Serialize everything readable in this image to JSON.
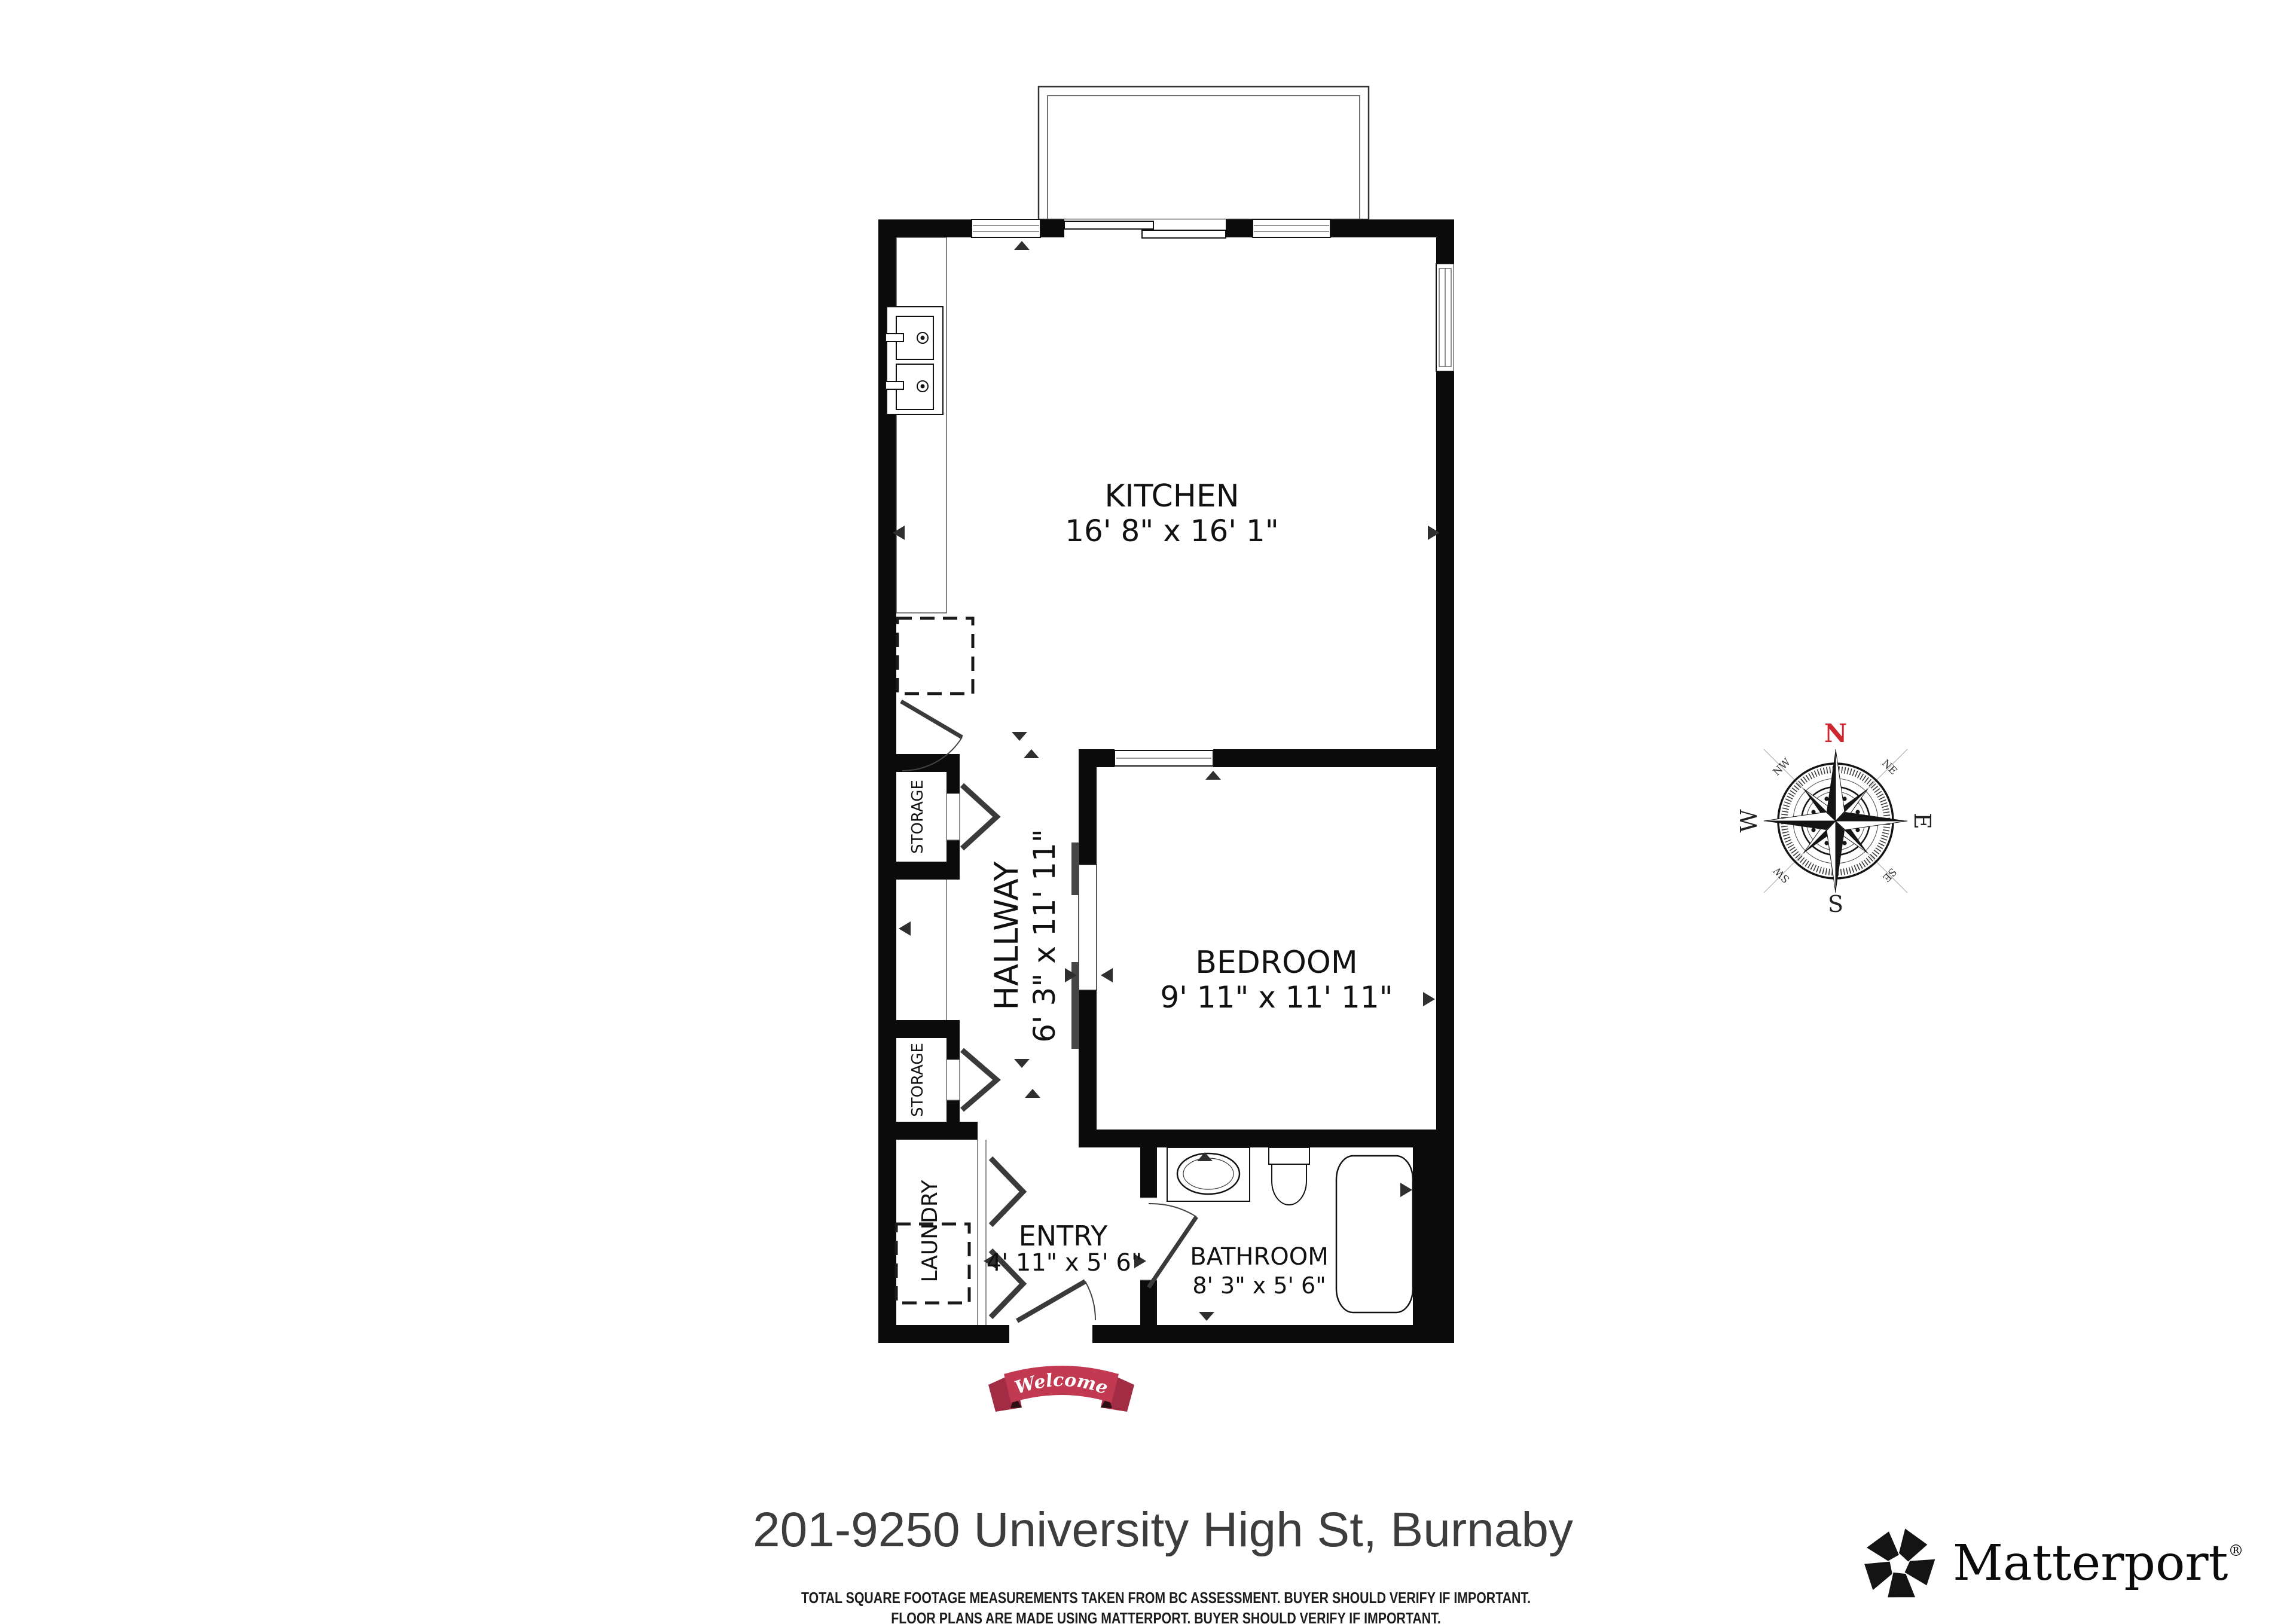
{
  "address": "201-9250 University High St, Burnaby",
  "disclaimer": {
    "line1": "TOTAL SQUARE FOOTAGE MEASUREMENTS TAKEN FROM BC ASSESSMENT. BUYER SHOULD VERIFY IF IMPORTANT.",
    "line2": "FLOOR PLANS ARE MADE USING MATTERPORT. BUYER SHOULD VERIFY IF IMPORTANT."
  },
  "branding": {
    "name": "Matterport",
    "registered": "®"
  },
  "banner": {
    "text": "Welcome",
    "ribbon_color": "#c23a52",
    "tail_color": "#a12c44"
  },
  "compass": {
    "north": "N",
    "east": "E",
    "south": "S",
    "west": "W",
    "northeast": "NE",
    "northwest": "NW",
    "southeast": "SE",
    "southwest": "SW",
    "north_color": "#cf2730"
  },
  "rooms": {
    "kitchen": {
      "name": "KITCHEN",
      "dims": "16' 8\" x 16' 1\""
    },
    "bedroom": {
      "name": "BEDROOM",
      "dims": "9' 11\" x 11' 11\""
    },
    "hallway": {
      "name": "HALLWAY",
      "dims": "6' 3\" x 11' 11\""
    },
    "entry": {
      "name": "ENTRY",
      "dims": "4' 11\" x 5' 6\""
    },
    "bathroom": {
      "name": "BATHROOM",
      "dims": "8' 3\" x 5' 6\""
    },
    "laundry": {
      "name": "LAUNDRY"
    },
    "storage_top": {
      "name": "STORAGE"
    },
    "storage_bottom": {
      "name": "STORAGE"
    }
  },
  "colors": {
    "wall": "#0b0b0b",
    "door": "#3a3a3a",
    "background": "#ffffff"
  }
}
